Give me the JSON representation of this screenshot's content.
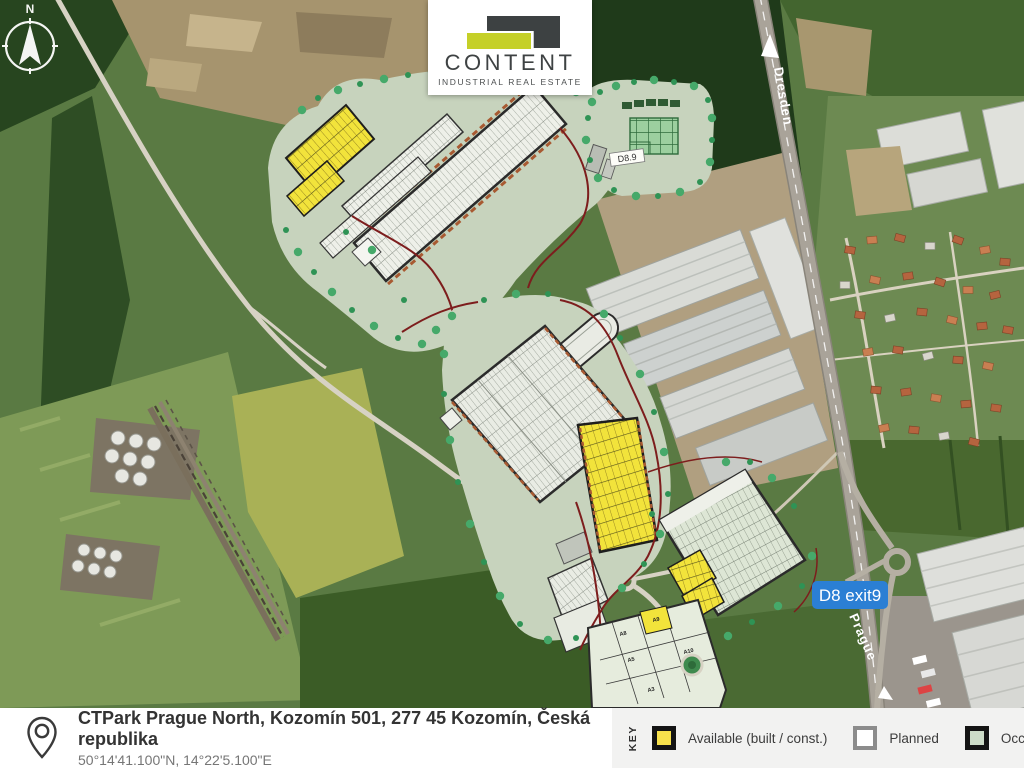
{
  "logo": {
    "brand": "CONTENT",
    "tagline": "INDUSTRIAL REAL ESTATE"
  },
  "map": {
    "compass": "N",
    "highway_top_label": "Dresden",
    "highway_bottom_label": "Prague",
    "exit_badge": "D8 exit9",
    "building_label": "D8.9",
    "parcel_labels": [
      "A9",
      "A8",
      "A5",
      "A3",
      "A10"
    ],
    "colors": {
      "badge_blue": "#2b7fd4",
      "boundary_red": "#7d1d1d",
      "available_yellow": "#f2e33b",
      "landscape_green": "#c7d3bd"
    }
  },
  "footer": {
    "address": "CTPark Prague North, Kozomín 501, 277 45 Kozomín, Česká republika",
    "coordinates": "50°14'41.100\"N, 14°22'5.100\"E",
    "key_label": "KEY",
    "legend": [
      {
        "label": "Available (built / const.)",
        "fill": "#f7e14c",
        "border": "#141414"
      },
      {
        "label": "Planned",
        "fill": "#ffffff",
        "border": "#8c8c8c"
      },
      {
        "label": "Occupied (",
        "fill": "#cddcc8",
        "border": "#141414"
      }
    ]
  }
}
